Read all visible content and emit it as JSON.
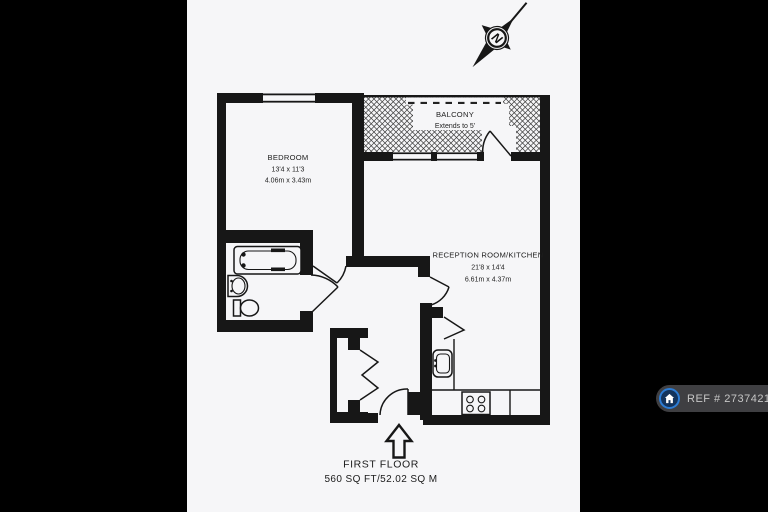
{
  "colors": {
    "background": "#000000",
    "paper": "#f6f6f8",
    "ink": "#171717",
    "badge_pill": "#3f3f42",
    "badge_text": "#c6c6c6",
    "badge_icon_ring": "#2d7cd3",
    "badge_icon_fill": "#14345c"
  },
  "compass": {
    "north_label": "N"
  },
  "rooms": {
    "bedroom": {
      "name": "BEDROOM",
      "size_imperial": "13'4 x 11'3",
      "size_metric": "4.06m x 3.43m"
    },
    "balcony": {
      "name": "BALCONY",
      "note": "Extends to 5'"
    },
    "reception": {
      "name": "RECEPTION ROOM/KITCHEN",
      "size_imperial": "21'8 x 14'4",
      "size_metric": "6.61m x 4.37m"
    }
  },
  "footer": {
    "floor": "FIRST FLOOR",
    "area": "560 SQ FT/52.02 SQ M"
  },
  "ref_badge": {
    "label": "REF # 2737421"
  },
  "fixtures": [
    "bathtub",
    "wash-basin",
    "toilet",
    "kitchen-sink",
    "hob",
    "worktop",
    "folding-door-storage",
    "entrance-door",
    "entrance-arrow",
    "compass-rose"
  ]
}
